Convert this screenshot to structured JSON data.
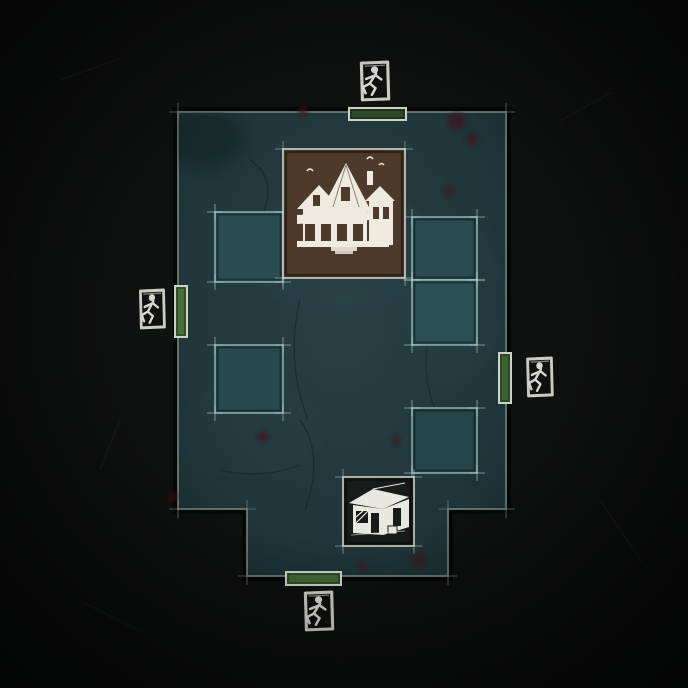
{
  "scene": {
    "description": "Top-down trial map overview with four exit gates, a main building landmark and a shack landmark",
    "background_color": "#0d0e0e"
  },
  "map": {
    "ground_color": "#20383c",
    "border_color": "#66746f",
    "tile_border_color": "#b2d8d0",
    "bar_border_color": "#ccd2c8",
    "icon_color": "#d8d7cf",
    "blood_color": "#4a1019",
    "outline": [
      [
        178,
        112
      ],
      [
        506,
        112
      ],
      [
        506,
        509
      ],
      [
        448,
        509
      ],
      [
        448,
        576
      ],
      [
        247,
        576
      ],
      [
        247,
        509
      ],
      [
        178,
        509
      ]
    ],
    "tiles": [
      {
        "id": "tile-west-upper",
        "x": 215,
        "y": 212,
        "w": 68,
        "h": 70,
        "fill": "#2b4d52"
      },
      {
        "id": "tile-east-upper",
        "x": 412,
        "y": 217,
        "w": 65,
        "h": 63,
        "fill": "#2a4a4f"
      },
      {
        "id": "tile-east-middle",
        "x": 412,
        "y": 280,
        "w": 65,
        "h": 65,
        "fill": "#2c4f54"
      },
      {
        "id": "tile-west-lower",
        "x": 215,
        "y": 345,
        "w": 68,
        "h": 68,
        "fill": "#284a4f"
      },
      {
        "id": "tile-east-lower",
        "x": 412,
        "y": 408,
        "w": 65,
        "h": 65,
        "fill": "#254549"
      }
    ],
    "landmarks": [
      {
        "id": "main-building",
        "icon": "victorian-house-icon",
        "x": 283,
        "y": 149,
        "w": 122,
        "h": 129,
        "fill": "#4e3a2b",
        "border": "#cdd2c9"
      },
      {
        "id": "killer-shack",
        "icon": "shack-icon",
        "x": 343,
        "y": 477,
        "w": 71,
        "h": 69,
        "fill": "#191b1a",
        "border": "#cdd2c9"
      }
    ],
    "gates": [
      {
        "id": "exit-gate-top",
        "side": "top",
        "icon_name": "exit-gate-runner-icon",
        "icon": {
          "x": 353,
          "y": 58,
          "w": 42,
          "h": 47
        },
        "bar": {
          "x": 349,
          "y": 108,
          "w": 57,
          "h": 12,
          "fill": "#2b4827"
        }
      },
      {
        "id": "exit-gate-left",
        "side": "left",
        "icon_name": "exit-gate-runner-icon",
        "icon": {
          "x": 133,
          "y": 286,
          "w": 37,
          "h": 47
        },
        "bar": {
          "x": 175,
          "y": 286,
          "w": 12,
          "h": 51,
          "fill": "#477039"
        }
      },
      {
        "id": "exit-gate-right",
        "side": "right",
        "icon_name": "exit-gate-runner-icon",
        "icon": {
          "x": 520,
          "y": 354,
          "w": 38,
          "h": 47
        },
        "bar": {
          "x": 499,
          "y": 353,
          "w": 12,
          "h": 50,
          "fill": "#3c6132"
        }
      },
      {
        "id": "exit-gate-bottom",
        "side": "bottom",
        "icon_name": "exit-gate-runner-icon",
        "icon": {
          "x": 297,
          "y": 588,
          "w": 42,
          "h": 47
        },
        "bar": {
          "x": 286,
          "y": 572,
          "w": 55,
          "h": 13,
          "fill": "#3e6634"
        }
      }
    ],
    "stains": [
      {
        "x": 303,
        "y": 111,
        "r": 5,
        "o": 0.7
      },
      {
        "x": 457,
        "y": 121,
        "r": 9,
        "o": 0.5
      },
      {
        "x": 472,
        "y": 139,
        "r": 6,
        "o": 0.55
      },
      {
        "x": 449,
        "y": 191,
        "r": 6,
        "o": 0.45
      },
      {
        "x": 263,
        "y": 437,
        "r": 6,
        "o": 0.55
      },
      {
        "x": 396,
        "y": 441,
        "r": 4,
        "o": 0.65
      },
      {
        "x": 419,
        "y": 560,
        "r": 8,
        "o": 0.45
      },
      {
        "x": 362,
        "y": 566,
        "r": 4,
        "o": 0.55
      },
      {
        "x": 388,
        "y": 258,
        "r": 4,
        "o": 0.45
      },
      {
        "x": 173,
        "y": 497,
        "r": 5,
        "o": 0.5
      }
    ]
  }
}
